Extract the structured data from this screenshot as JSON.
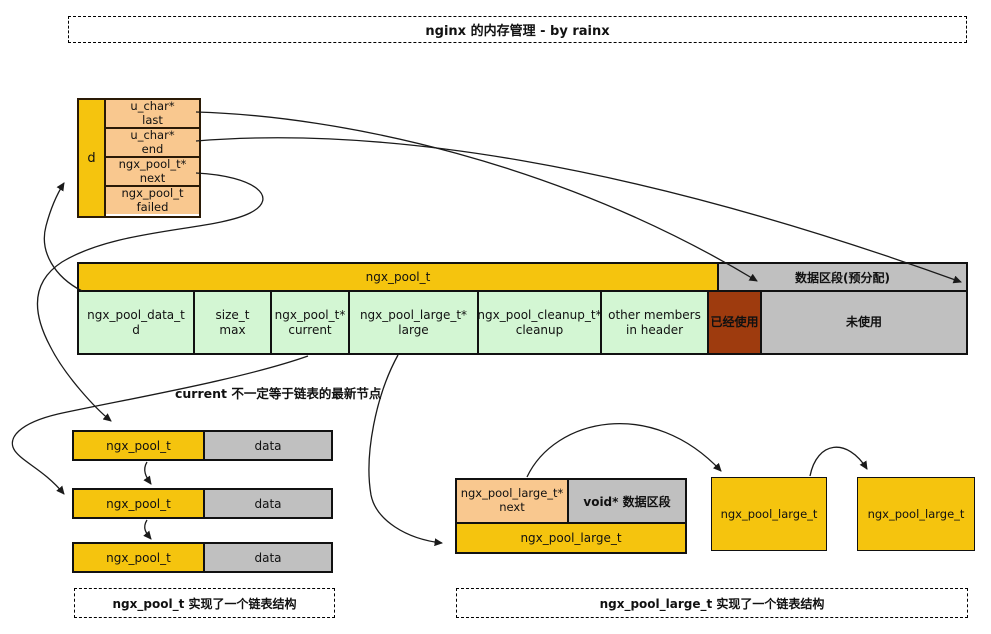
{
  "title": "nginx 的内存管理 - by rainx",
  "colors": {
    "node_yellow": "#F5C40E",
    "field_peach": "#F9C88F",
    "member_green": "#D3F6D3",
    "data_gray": "#C0C0C0",
    "used_red": "#9E3B0E",
    "line": "#1a1a1a"
  },
  "d_struct": {
    "label": "d",
    "fields": [
      {
        "type": "u_char*",
        "name": "last"
      },
      {
        "type": "u_char*",
        "name": "end"
      },
      {
        "type": "ngx_pool_t*",
        "name": "next"
      },
      {
        "type": "ngx_pool_t",
        "name": "failed"
      }
    ]
  },
  "pool_bar": {
    "header": "ngx_pool_t",
    "data_header": "数据区段(预分配)",
    "cells": [
      {
        "type": "ngx_pool_data_t",
        "name": "d"
      },
      {
        "type": "size_t",
        "name": "max"
      },
      {
        "type": "ngx_pool_t*",
        "name": "current"
      },
      {
        "type": "ngx_pool_large_t*",
        "name": "large"
      },
      {
        "type": "ngx_pool_cleanup_t*",
        "name": "cleanup"
      },
      {
        "type": "other members",
        "name": "in header"
      }
    ],
    "used_label": "已经使用",
    "unused_label": "未使用"
  },
  "note": "current 不一定等于链表的最新节点",
  "chain": {
    "node_label": "ngx_pool_t",
    "data_label": "data",
    "caption": "ngx_pool_t 实现了一个链表结构"
  },
  "large_struct": {
    "next_type": "ngx_pool_large_t*",
    "next_name": "next",
    "data_label": "void* 数据区段",
    "label": "ngx_pool_large_t"
  },
  "large_nodes": {
    "node1": "ngx_pool_large_t",
    "node2": "ngx_pool_large_t"
  },
  "large_caption": "ngx_pool_large_t 实现了一个链表结构"
}
